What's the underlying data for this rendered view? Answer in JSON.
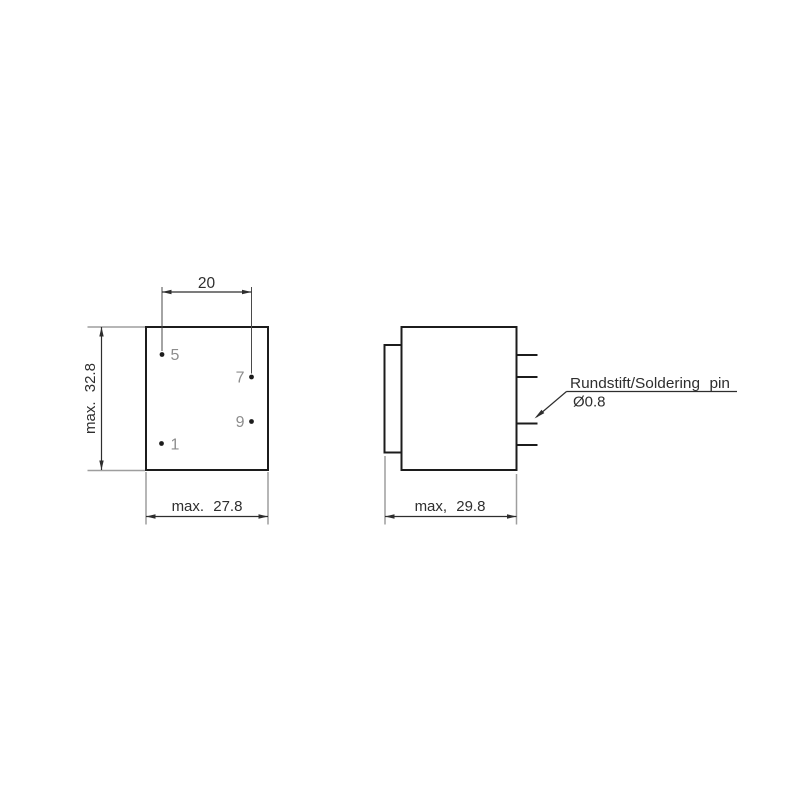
{
  "colors": {
    "background": "#ffffff",
    "outline": "#1c1c1c",
    "dimension": "#2e2e2e",
    "extension": "#9e9e9e",
    "pin_ext": "#4a4a4a",
    "pin_label": "#8d8d8d"
  },
  "front_view": {
    "pin_spacing_dim": "20",
    "height_dim": "max. 32.8",
    "width_dim": "max. 27.8",
    "pins": [
      {
        "label": "5"
      },
      {
        "label": "7"
      },
      {
        "label": "9"
      },
      {
        "label": "1"
      }
    ]
  },
  "side_view": {
    "width_dim": "max, 29.8",
    "callout": {
      "line1": "Rundstift/Soldering pin",
      "line2": "Ø0.8"
    }
  }
}
